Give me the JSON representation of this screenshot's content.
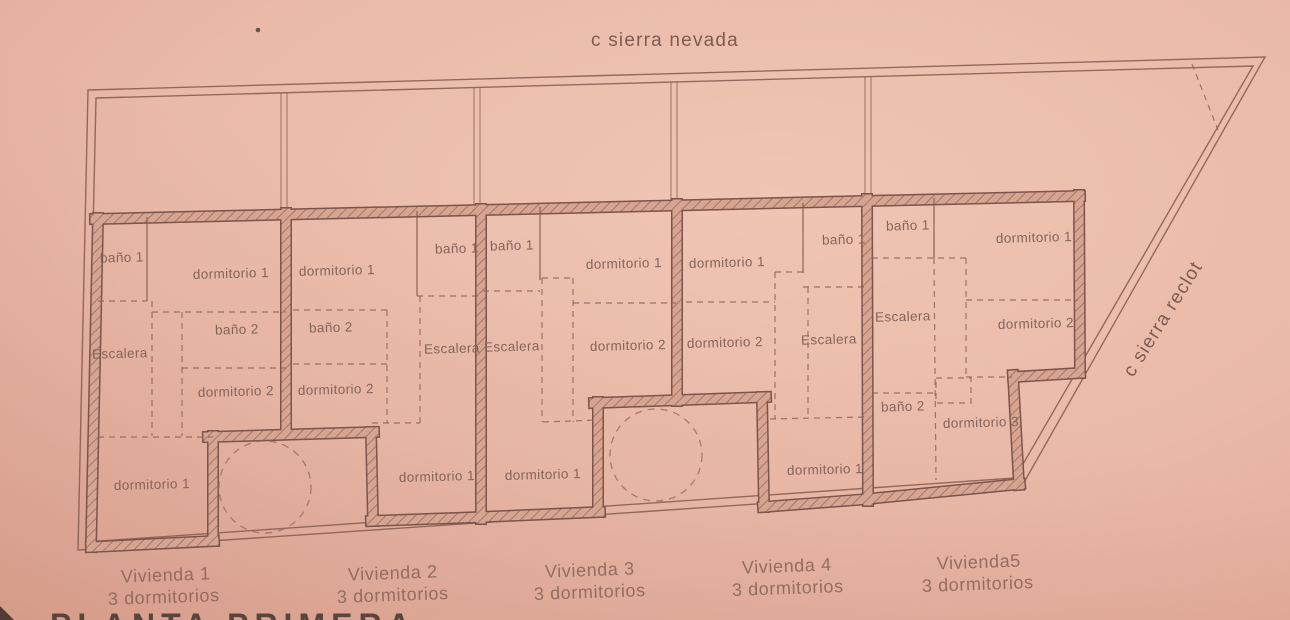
{
  "colors": {
    "paper": "#eab9a8",
    "line": "#84594c",
    "wall_fill": "#d6a492",
    "wall_hatch": "#a87763",
    "label_text": "#85645a",
    "title_text": "#5a443b"
  },
  "streets": {
    "top": "c sierra nevada",
    "right": "c sierra reclot"
  },
  "plan_title_partial": "PLANTA PRIMERA",
  "viviendas": [
    {
      "caption_line1": "Vivienda 1",
      "caption_line2": "3 dormitorios",
      "rooms": {
        "bano1": "baño 1",
        "dorm1": "dormitorio 1",
        "escalera": "Escalera",
        "bano2": "baño 2",
        "dorm2": "dormitorio 2",
        "dorm1_bottom": "dormitorio 1"
      }
    },
    {
      "caption_line1": "Vivienda 2",
      "caption_line2": "3 dormitorios",
      "rooms": {
        "bano1": "baño 1",
        "dorm1": "dormitorio 1",
        "escalera": "Escalera",
        "bano2": "baño 2",
        "dorm2": "dormitorio 2",
        "dorm1_bottom": "dormitorio 1"
      }
    },
    {
      "caption_line1": "Vivienda 3",
      "caption_line2": "3 dormitorios",
      "rooms": {
        "bano1": "baño 1",
        "dorm1": "dormitorio 1",
        "escalera": "Escalera",
        "dorm2": "dormitorio 2",
        "dorm1_bottom": "dormitorio 1"
      }
    },
    {
      "caption_line1": "Vivienda 4",
      "caption_line2": "3 dormitorios",
      "rooms": {
        "bano1": "baño 1",
        "dorm1": "dormitorio 1",
        "escalera": "Escalera",
        "dorm2": "dormitorio 2",
        "dorm1_bottom": "dormitorio 1"
      }
    },
    {
      "caption_line1": "Vivienda5",
      "caption_line2": "3 dormitorios",
      "rooms": {
        "bano1": "baño 1",
        "dorm1": "dormitorio 1",
        "escalera": "Escalera",
        "dorm2": "dormitorio 2",
        "bano2": "baño 2",
        "dorm3": "dormitorio 3"
      }
    }
  ]
}
